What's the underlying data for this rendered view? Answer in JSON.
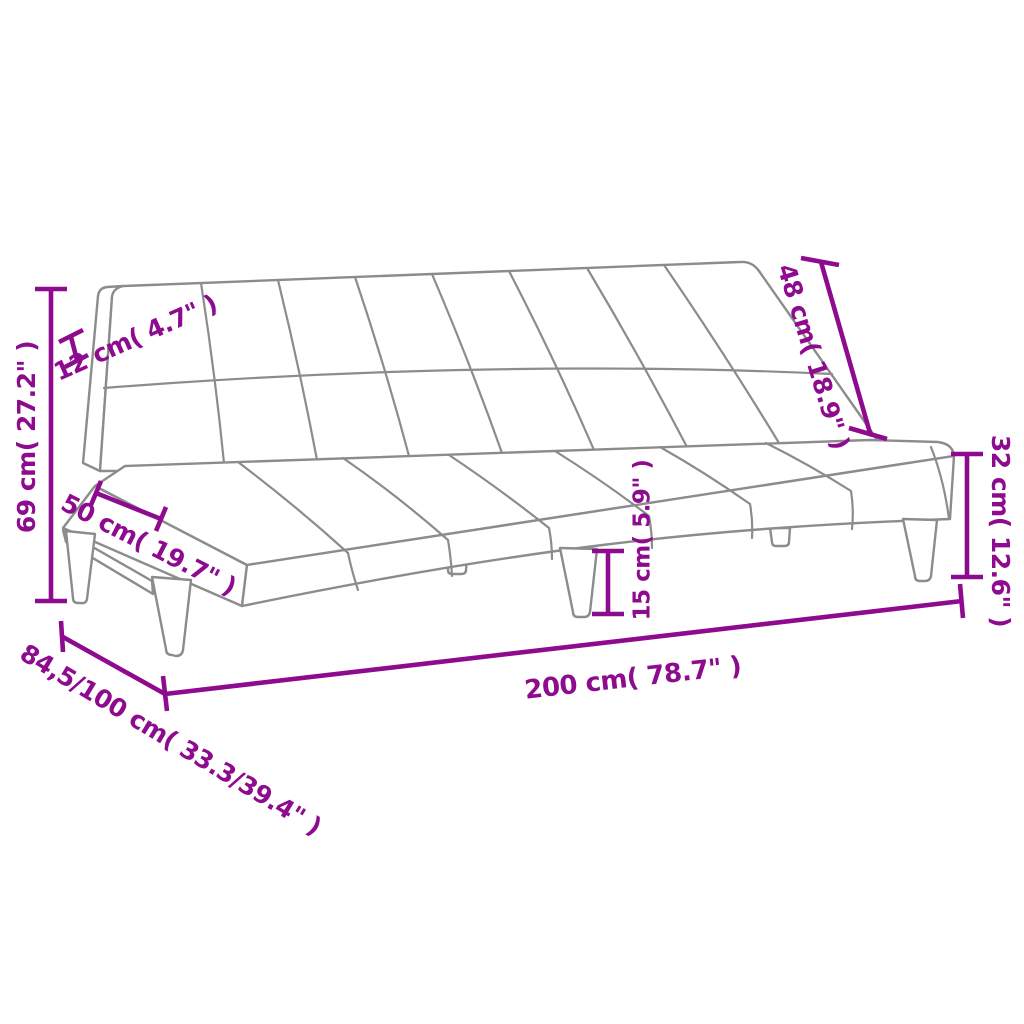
{
  "colors": {
    "dimension": "#8E0A8E",
    "outline": "#8C8C8C",
    "background": "#FFFFFF"
  },
  "dimensions": {
    "back_height": "69 cm( 27.2\" )",
    "back_thickness": "12 cm( 4.7\" )",
    "seat_depth": "50 cm( 19.7\" )",
    "backrest_length": "48 cm( 18.9\" )",
    "seat_height": "32 cm( 12.6\" )",
    "leg_height": "15 cm( 5.9\" )",
    "overall_length": "200 cm( 78.7\" )",
    "overall_depth": "84,5/100 cm( 33.3/39.4\" )"
  }
}
